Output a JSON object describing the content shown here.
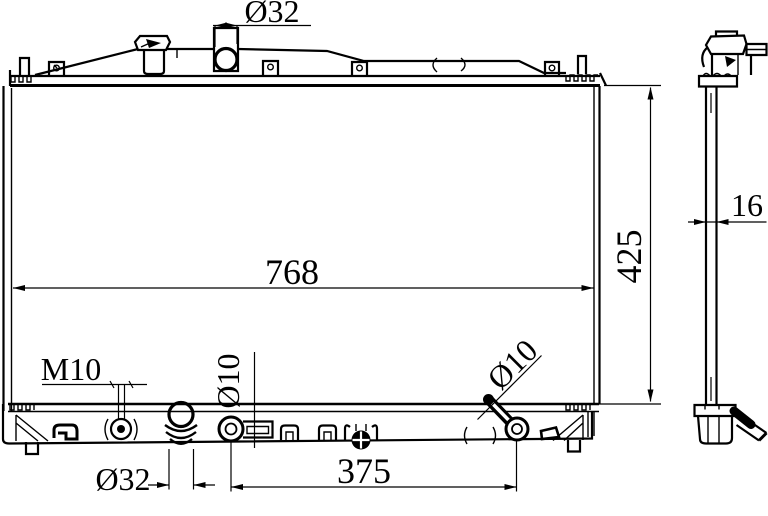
{
  "document": {
    "type": "technical-drawing",
    "subject": "automotive radiator two-view dimensional drawing",
    "background_color": "#ffffff",
    "line_color": "#000000"
  },
  "front_view": {
    "dim_inlet_diameter": "Ø32",
    "dim_core_width": "768",
    "dim_overall_height": "425",
    "dim_drain_thread": "M10",
    "dim_left_fitting_diameter": "Ø10",
    "dim_outlet_diameter": "Ø32",
    "dim_fitting_span": "375",
    "dim_right_fitting_diameter": "Ø10"
  },
  "side_view": {
    "dim_core_thickness": "16"
  }
}
